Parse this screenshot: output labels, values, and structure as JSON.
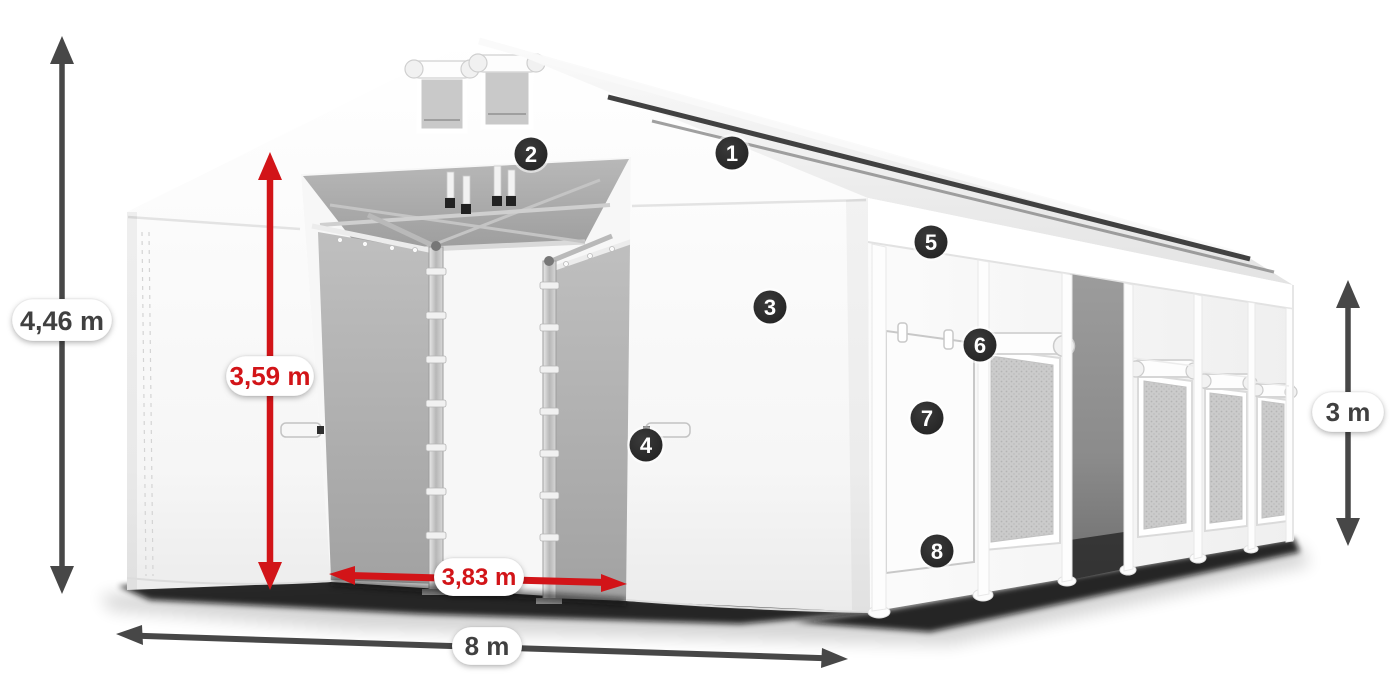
{
  "dimensions": {
    "dim_total_height": {
      "label": "4,46 m",
      "color": "gray"
    },
    "dim_entrance_height": {
      "label": "3,59 m",
      "color": "red"
    },
    "dim_side_height": {
      "label": "3 m",
      "color": "gray"
    },
    "dim_entrance_width": {
      "label": "3,83 m",
      "color": "red"
    },
    "dim_total_width": {
      "label": "8 m",
      "color": "gray"
    }
  },
  "markers": [
    {
      "label": "1"
    },
    {
      "label": "2"
    },
    {
      "label": "3"
    },
    {
      "label": "4"
    },
    {
      "label": "5"
    },
    {
      "label": "6"
    },
    {
      "label": "7"
    },
    {
      "label": "8"
    }
  ],
  "colors": {
    "accent_red": "#d21418",
    "dimension_gray": "#474747",
    "marker_background": "#2b2b2b"
  }
}
